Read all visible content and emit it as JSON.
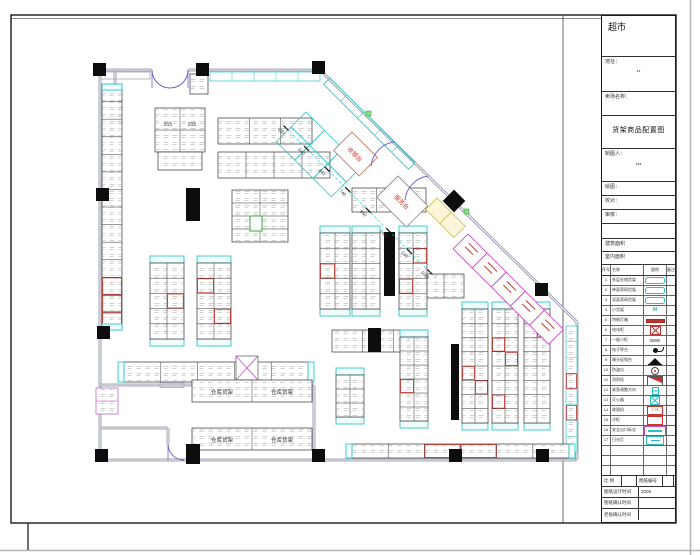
{
  "title_block": {
    "store_name": "超市",
    "fields": [
      {
        "label": "地址：",
        "value": "**"
      },
      {
        "label": "卖场名称：",
        "value": ""
      }
    ],
    "drawing_title": "货架商品配置图",
    "drafter": {
      "label": "制图人：",
      "value": "***"
    },
    "sign_rows": [
      {
        "label": "绘图："
      },
      {
        "label": "校对："
      },
      {
        "label": "审核："
      }
    ],
    "area_rows": [
      {
        "label": "建筑面积"
      },
      {
        "label": "室内面积"
      }
    ],
    "legend": {
      "headers": [
        "序号",
        "名称",
        "图例",
        "备注"
      ],
      "rows": [
        {
          "no": "1",
          "name": "多层仓储货架",
          "sym": "pill"
        },
        {
          "no": "2",
          "name": "单面背网货架",
          "sym": "pill"
        },
        {
          "no": "3",
          "name": "双面背网货架",
          "sym": "pill"
        },
        {
          "no": "4",
          "name": "小货架",
          "sym": "text",
          "sym_text": "M"
        },
        {
          "no": "5",
          "name": "特制灯箱",
          "sym": "redbar"
        },
        {
          "no": "6",
          "name": "电冰柜",
          "sym": "redx"
        },
        {
          "no": "7",
          "name": "一般小柜",
          "sym": "gray"
        },
        {
          "no": "8",
          "name": "电子秤台",
          "sym": "dot"
        },
        {
          "no": "9",
          "name": "端头促销台",
          "sym": "tri"
        },
        {
          "no": "10",
          "name": "防盗仪",
          "sym": "circle"
        },
        {
          "no": "11",
          "name": "消防栓",
          "sym": "flag"
        },
        {
          "no": "12",
          "name": "紧急疏散方向",
          "sym": "exit"
        },
        {
          "no": "13",
          "name": "灭火器",
          "sym": "cyanx"
        },
        {
          "no": "14",
          "name": "收银机",
          "sym": "redbox",
          "sym_text": "1.75"
        },
        {
          "no": "15",
          "name": "冷柜",
          "sym": "redbox",
          "sym_text": ""
        },
        {
          "no": "16",
          "name": "安全出口标志",
          "sym": "mgbox"
        },
        {
          "no": "17",
          "name": "日光灯",
          "sym": "cyanbox"
        },
        {
          "no": "",
          "name": "",
          "sym": "none"
        },
        {
          "no": "",
          "name": "",
          "sym": "none"
        },
        {
          "no": "",
          "name": "",
          "sym": "none"
        }
      ]
    },
    "footer": {
      "scale_label": "比 例",
      "sheet_no_label": "图纸编号",
      "rows": [
        {
          "label": "图纸设计时间",
          "value": "2008"
        },
        {
          "label": "图纸确认时间",
          "value": ""
        },
        {
          "label": "老板确认时间",
          "value": ""
        }
      ]
    }
  },
  "plan": {
    "labels": {
      "cashier": "收银台",
      "service": "服务台",
      "warehouse": "仓库货架",
      "unit_no": "915"
    },
    "dimensions": [
      "650",
      "640",
      "640",
      "740",
      "650",
      "1460",
      "130",
      "1060"
    ],
    "colors": {
      "wall": "#8a8ea6",
      "shelf_cyan": "#2fc7c7",
      "accent_red": "#cc3a30",
      "magenta": "#c44fc4",
      "green": "#3aa843",
      "column_black": "#0d0d0d",
      "pale_yellow": "#fbf6da"
    }
  }
}
